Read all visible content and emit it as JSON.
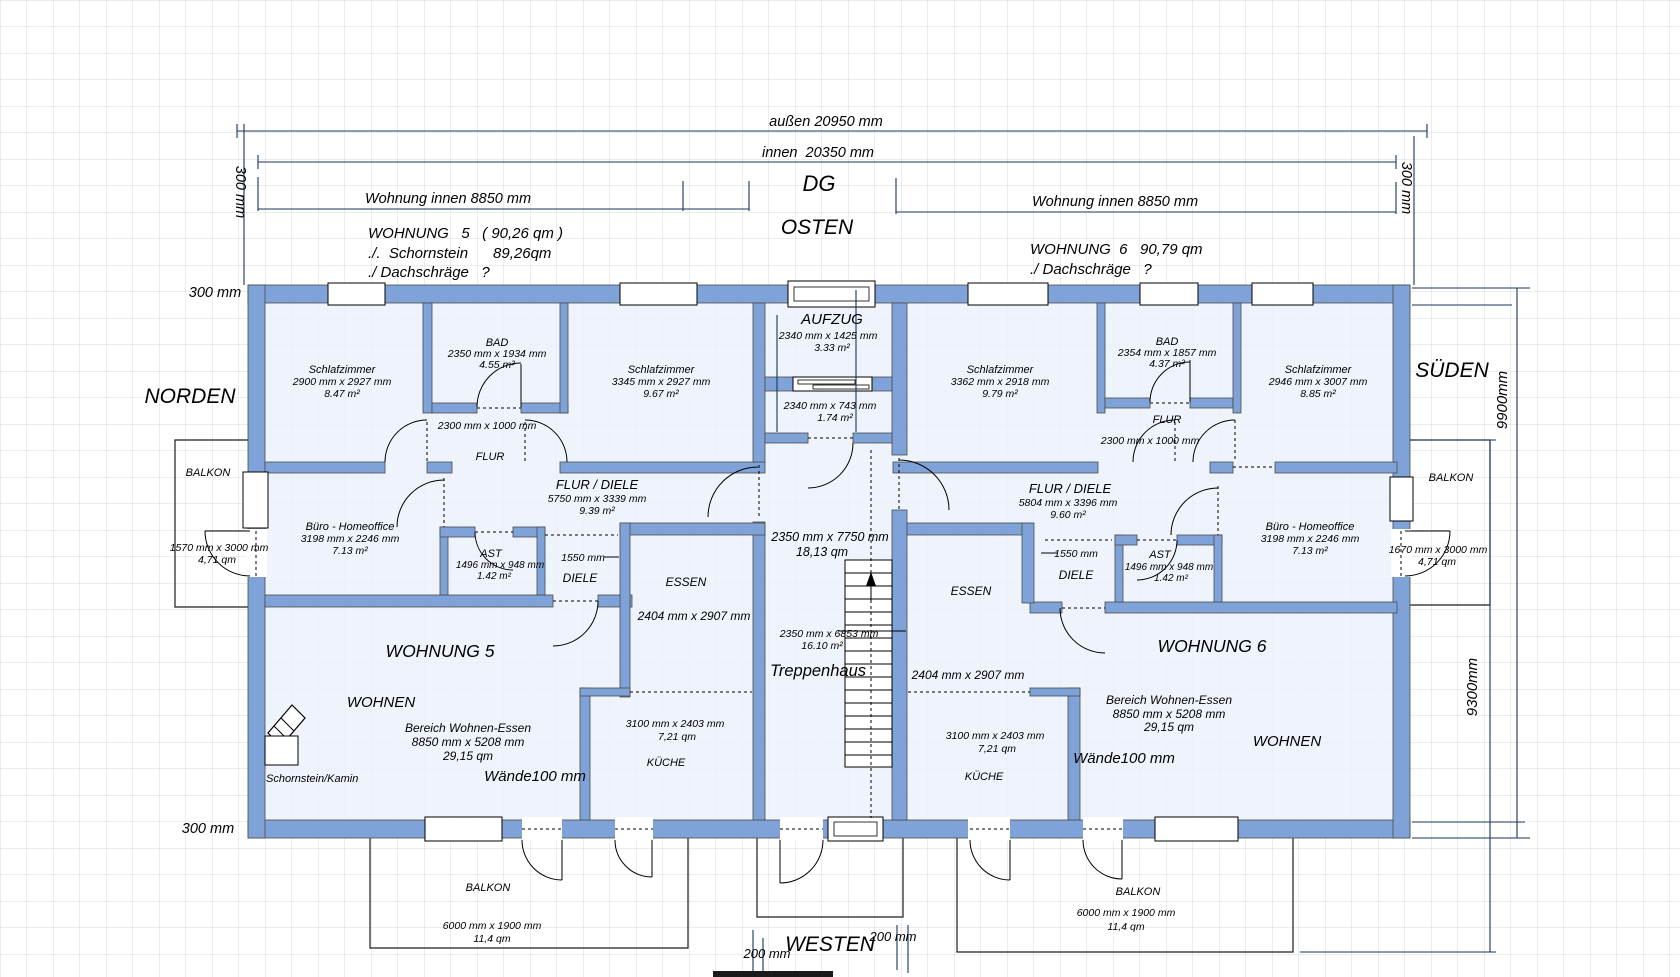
{
  "header": {
    "outer_width": "außen 20950 mm",
    "inner_width": "innen  20350 mm",
    "apt5_inner_width": "Wohnung innen 8850 mm",
    "apt6_inner_width": "Wohnung innen 8850 mm",
    "floor_label": "DG",
    "apt5_title_1": "WOHNUNG   5   ( 90,26 qm )",
    "apt5_title_2": "./.  Schornstein      89,26qm",
    "apt5_title_3": "./ Dachschräge   ?",
    "apt6_title_1": "WOHNUNG  6   90,79 qm",
    "apt6_title_2": "./ Dachschräge   ?"
  },
  "compass": {
    "north": "NORDEN",
    "east": "OSTEN",
    "south": "SÜDEN",
    "west": "WESTEN"
  },
  "side_dims": {
    "wall_top_left": "300 mm",
    "wall_top_right": "300 mm",
    "wall_left_top": "300 mm",
    "wall_left_bottom": "300 mm",
    "height_outer": "9900mm",
    "height_inner": "9300mm",
    "gap_left": "200 mm",
    "gap_right": "200 mm"
  },
  "apt5": {
    "name": "WOHNUNG 5",
    "bedroom1": {
      "name": "Schlafzimmer",
      "dims": "2900 mm x 2927 mm",
      "area": "8.47 m²"
    },
    "bath": {
      "name": "BAD",
      "dims": "2350 mm x 1934 mm",
      "area": "4.55 m²"
    },
    "bedroom2": {
      "name": "Schlafzimmer",
      "dims": "3345 mm x 2927 mm",
      "area": "9.67 m²"
    },
    "flur": {
      "name": "FLUR",
      "dims": "2300 mm x 1000 mm"
    },
    "hall": {
      "name": "FLUR / DIELE",
      "dims": "5750 mm x 3339 mm",
      "area": "9.39 m²"
    },
    "office": {
      "name": "Büro - Homeoffice",
      "dims": "3198 mm x 2246 mm",
      "area": "7.13 m²"
    },
    "ast": {
      "name": "AST",
      "dims": "1496 mm x 948 mm",
      "area": "1.42 m²"
    },
    "diele": {
      "name": "DIELE",
      "width": "1550 mm"
    },
    "essen": {
      "name": "ESSEN",
      "dims": "2404 mm x 2907 mm"
    },
    "kitchen": {
      "name": "KÜCHE",
      "dims": "3100 mm x 2403 mm",
      "area": "7,21 qm"
    },
    "living": {
      "name": "WOHNEN",
      "zone": "Bereich Wohnen-Essen",
      "zone_dims": "8850 mm x 5208 mm",
      "zone_area": "29,15 qm"
    },
    "walls_note": "Wände100 mm",
    "chimney": "Schornstein/Kamin",
    "balcony_side": {
      "name": "BALKON",
      "dims": "1570 mm x 3000 mm",
      "area": "4,71 qm"
    },
    "balcony_bottom": {
      "name": "BALKON",
      "dims": "6000 mm x 1900 mm",
      "area": "11,4 qm"
    }
  },
  "apt6": {
    "name": "WOHNUNG 6",
    "bedroom1": {
      "name": "Schlafzimmer",
      "dims": "3362 mm x 2918 mm",
      "area": "9.79 m²"
    },
    "bath": {
      "name": "BAD",
      "dims": "2354 mm x 1857 mm",
      "area": "4.37 m²"
    },
    "bedroom2": {
      "name": "Schlafzimmer",
      "dims": "2946 mm x 3007 mm",
      "area": "8.85 m²"
    },
    "flur": {
      "name": "FLUR",
      "dims": "2300 mm x 1000 mm"
    },
    "hall": {
      "name": "FLUR / DIELE",
      "dims": "5804 mm x 3396 mm",
      "area": "9.60 m²"
    },
    "office": {
      "name": "Büro - Homeoffice",
      "dims": "3198 mm x 2246 mm",
      "area": "7.13 m²"
    },
    "ast": {
      "name": "AST",
      "dims": "1496 mm x 948 mm",
      "area": "1.42 m²"
    },
    "diele": {
      "name": "DIELE",
      "width": "1550 mm"
    },
    "essen": {
      "name": "ESSEN",
      "dims": "2404 mm x 2907 mm"
    },
    "kitchen": {
      "name": "KÜCHE",
      "dims": "3100 mm x 2403 mm",
      "area": "7,21 qm"
    },
    "living": {
      "name": "WOHNEN",
      "zone": "Bereich Wohnen-Essen",
      "zone_dims": "8850 mm x 5208 mm",
      "zone_area": "29,15 qm"
    },
    "walls_note": "Wände100 mm",
    "balcony_side": {
      "name": "BALKON",
      "dims": "1670 mm x 3000 mm",
      "area": "4,71 qm"
    },
    "balcony_bottom": {
      "name": "BALKON",
      "dims": "6000 mm x 1900 mm",
      "area": "11,4 qm"
    }
  },
  "core": {
    "elevator": {
      "name": "AUFZUG",
      "dims": "2340 mm x 1425 mm",
      "area": "3.33 m²"
    },
    "vestibule": {
      "dims": "2340 mm x 743 mm",
      "area": "1.74 m²"
    },
    "shaft": {
      "dims": "2350 mm x 7750 mm",
      "area": "18,13 qm"
    },
    "stair": {
      "name": "Treppenhaus",
      "dims": "2350 mm x 6853 mm",
      "area": "16.10 m²"
    }
  },
  "colors": {
    "wall": "#7fa3d8",
    "dimension": "#17365d",
    "floor": "#ebf0fa",
    "grid": "#d9d9d9"
  }
}
